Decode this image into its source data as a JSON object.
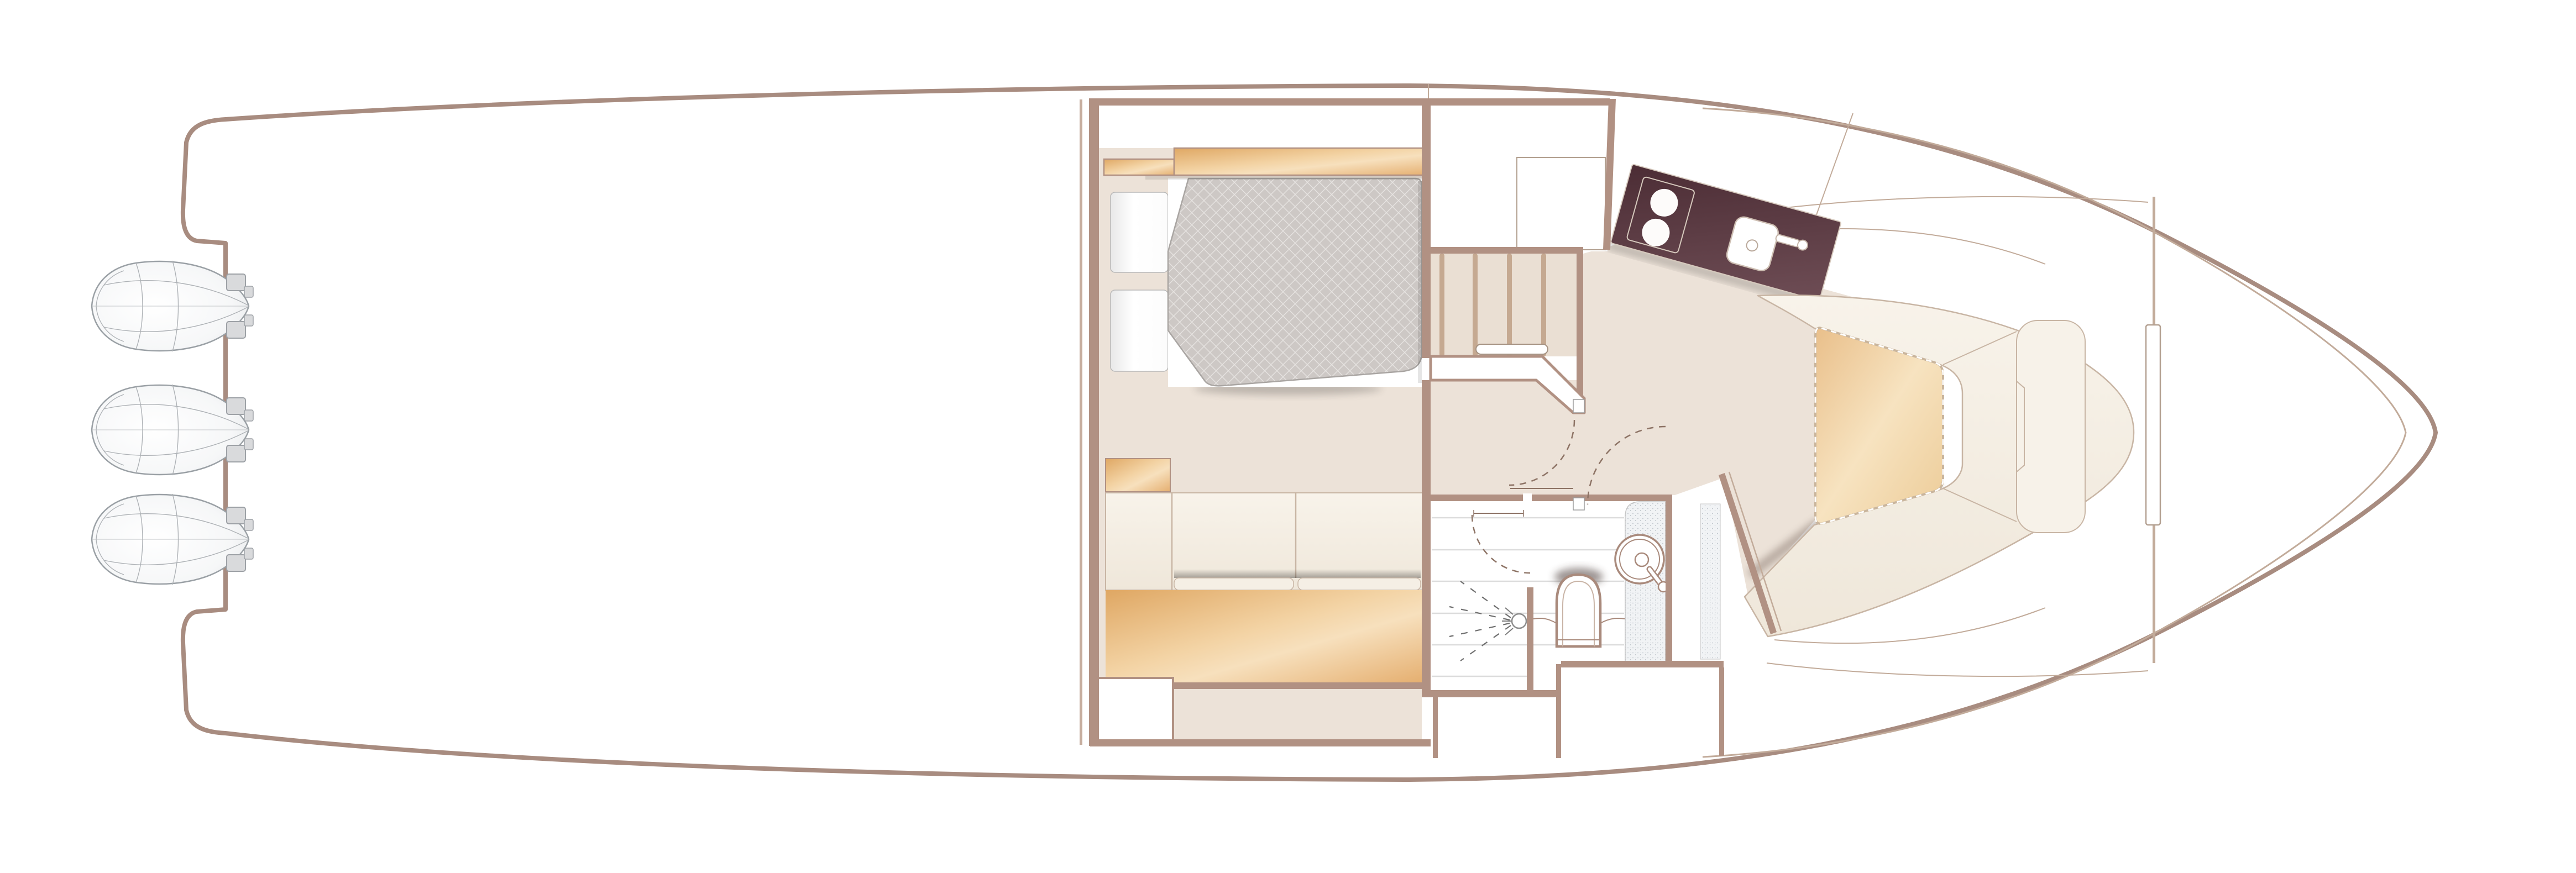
{
  "meta": {
    "title": "Yacht lower-deck floor plan",
    "kind": "floorplan-diagram",
    "text_labels_visible": false
  },
  "palette": {
    "hull": "#a88c80",
    "wall": "#b19183",
    "wall-thin": "#c6ad9e",
    "seam": "#c2ab9a",
    "floor": "#ece2d8",
    "floor-stair": "#eadfd3",
    "tread": "#c5a991",
    "cream": "#f5efe6",
    "cream-2": "#efe7da",
    "cream-edge": "#c8b5a4",
    "wood-1": "#dfa763",
    "wood-2": "#f3d3a4",
    "wood-3": "#e5af70",
    "tbl-1": "#e9bf8a",
    "tbl-2": "#f7e3c0",
    "quilt": "#cdc8c5",
    "quilt-line": "#e6e3e1",
    "quilt-edge": "#a9a5a2",
    "counter-1": "#4c2d35",
    "counter-2": "#6e4d55",
    "counter-edge": "#d6c9bd",
    "stripe": "#dcdcdc",
    "speck-base": "#f1f3f5",
    "speck-dot": "#b9c0c7",
    "eng-line": "#9aa0a5",
    "eng-fill": "#f6f7f8",
    "bracket": "#d9dadc",
    "arc": "#8d7365",
    "fixture": "#a98a7c",
    "white": "#ffffff"
  },
  "components": {
    "engines": {
      "count": 3,
      "icon": "outboard-engine-icon"
    },
    "aft_cockpit": {
      "features": []
    },
    "master_cabin": {
      "pillows": 2,
      "bed": "double-berth-quilted",
      "headboard_wood_panels": 2,
      "sofa_sections": 3,
      "wood_floor_panels": 2,
      "nightstand": 1
    },
    "staircase": {
      "treads": 5,
      "handrail": 1
    },
    "galley": {
      "hob_burners": 2,
      "sink": 1,
      "faucet": 1,
      "cabinet": 1
    },
    "shower_room": {
      "shower_head": 1,
      "toilet": 1,
      "basin": 1,
      "mixer_handle": 1,
      "floor_stripes": 6
    },
    "bow_dinette": {
      "table": 1,
      "u_settee": 1,
      "backrest_panel": 1,
      "foredeck_hatch": 1
    },
    "door_swings": 3
  }
}
